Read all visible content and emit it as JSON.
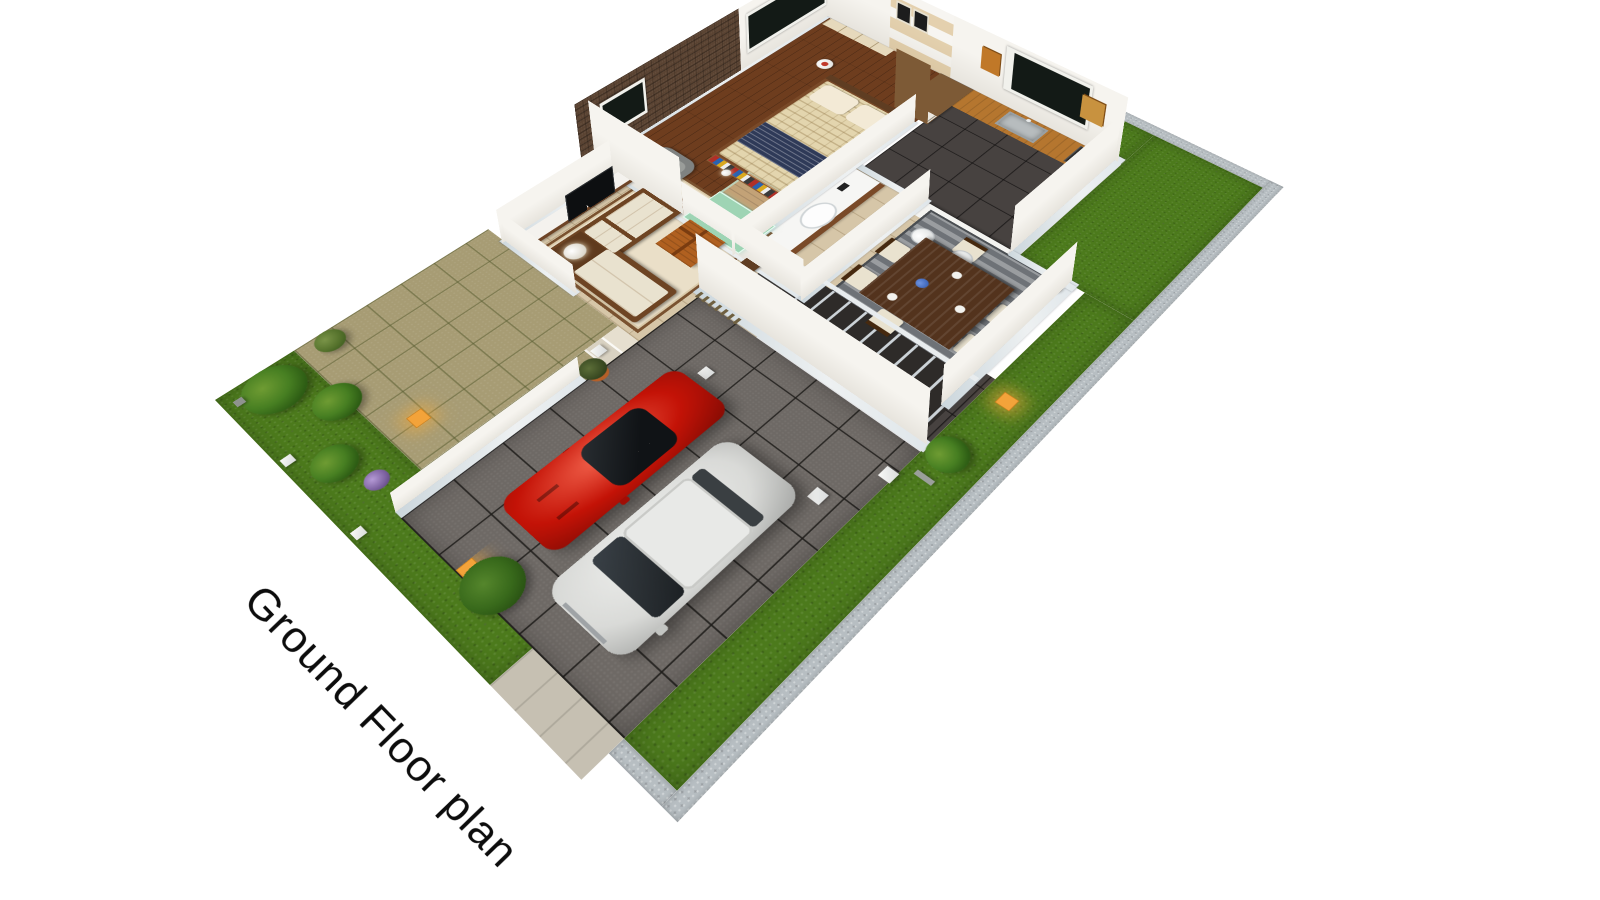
{
  "title": {
    "text": "Ground Floor plan"
  },
  "palette": {
    "background": "#ffffff",
    "wall": "#f3f1ec",
    "wall_cap": "#ccd7dd",
    "brick": "#5a4332",
    "grass": "#4c7a1c",
    "curb": "#b7bec2",
    "driveway": "#6e6965",
    "tile_beige": "#d6c6a8",
    "tile_dark": "#474240",
    "wood_floor": "#6e3d1e",
    "stone_path": "#a79c74",
    "counter_wood": "#b5762f",
    "cabinet_orange": "#c07828",
    "table_wood": "#53331d",
    "sofa_cream": "#e9e2cf",
    "sofa_frame": "#6e4423",
    "rug_living": "#eadfc8",
    "rug_dining": "#6e7277",
    "stair_tread": "#2e2b29",
    "stair_stringer": "#e8ecee",
    "shower_glass": "#9ed4b4",
    "red_car": "#c41307",
    "suv_silver": "#d9dad8",
    "pouf": "#2b3753",
    "lantern": "#f3a33a",
    "bed_duvet": "#e3d5ae",
    "bed_runner": "#2f3a58",
    "wardrobe": "#7d5a36"
  },
  "scene": {
    "view": "3d-isometric-cutaway",
    "rooms": [
      "bedroom",
      "bathroom",
      "kitchen",
      "dining-area",
      "living-room",
      "hallway-staircase",
      "porch",
      "garden",
      "driveway",
      "lawn"
    ],
    "objects": [
      "double-bed",
      "wardrobe",
      "built-in-closet",
      "armchair",
      "bedside-table",
      "floor-lamp",
      "vanity-sink",
      "glass-shower",
      "kitchen-counter",
      "kitchen-sink",
      "wall-cabinets",
      "breakfast-bar",
      "bar-stools",
      "dining-table",
      "dining-chairs",
      "dining-rug",
      "staircase",
      "slat-screen",
      "pouf",
      "tv-console",
      "television",
      "corner-sofa",
      "coffee-table",
      "living-rug",
      "flower-vase",
      "potted-plants",
      "garden-lanterns",
      "lamp-posts",
      "red-sports-car",
      "white-suv",
      "gate-pillars",
      "lawn-strips"
    ]
  }
}
